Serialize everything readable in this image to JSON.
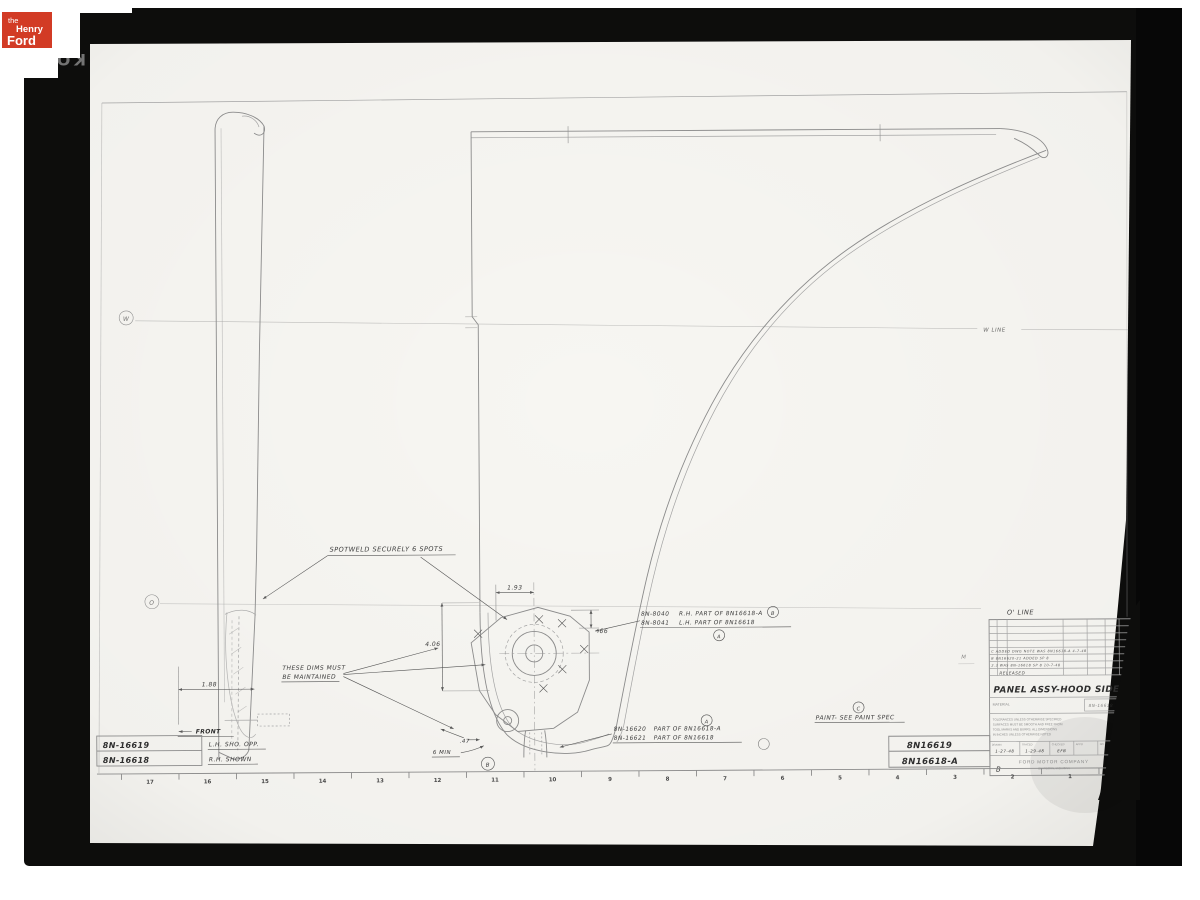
{
  "colors": {
    "logo_red": "#d23b25",
    "film_black": "#0d0d0c",
    "paper": "#f7f6f2",
    "ink": "#3b3b3b"
  },
  "branding": {
    "logo": {
      "line1": "the",
      "line2": "Henry",
      "line3": "Ford"
    },
    "film_marking": "KOD"
  },
  "callouts": {
    "spotweld": "SPOTWELD SECURELY 6 SPOTS",
    "maintain_1": "THESE DIMS MUST",
    "maintain_2": "BE MAINTAINED",
    "hinge_rh_num": "8N-8040",
    "hinge_rh_desc": "R.H. PART OF 8N16618-A",
    "hinge_lh_num": "8N-8041",
    "hinge_lh_desc": "L.H. PART OF 8N16618",
    "brace_rh_num": "8N-16620",
    "brace_rh_desc": "PART OF 8N16618-A",
    "brace_lh_num": "8N-16621",
    "brace_lh_desc": "PART OF 8N16618",
    "paint": "PAINT- SEE PAINT SPEC",
    "front": "FRONT"
  },
  "dimensions": {
    "width_193": "1.93",
    "depth_66": ".66",
    "height_406": "4.06",
    "width_188": "1.88",
    "width_47": ".47",
    "min_6": "6 MIN"
  },
  "datums": {
    "w_line": "W LINE",
    "o_line": "O' LINE",
    "w": "W",
    "o": "O",
    "a": "A",
    "b": "B",
    "c": "C",
    "b_section": "B",
    "m": "M"
  },
  "part_list": {
    "rows": [
      {
        "number": "8N-16619",
        "note": "L.H. SHO. OPP."
      },
      {
        "number": "8N-16618",
        "note": "R.H. SHOWN"
      }
    ]
  },
  "corner_numbers": [
    "8N16619",
    "8N16618-A"
  ],
  "title_block": {
    "revisions": [
      "C  ADDED DWG NOTE  WAS 8N16618-A  4-7-48",
      "B  8N16620-21 ADDED  SP 8",
      "2.3  WAS 8N-16618  SP 8  10-7-48"
    ],
    "released": "RELEASED",
    "title": "PANEL ASSY-HOOD SIDE",
    "material_label": "MATERIAL",
    "material_value": "8N-16618",
    "tolerance_note": [
      "TOLERANCES UNLESS OTHERWISE SPECIFIED",
      "SURFACES MUST BE SMOOTH AND FREE FROM",
      "TOOL MARKS AND BURRS. ALL DIMENSIONS",
      "IN INCHES UNLESS OTHERWISE NOTED"
    ],
    "sign_labels": [
      "DRAWN",
      "TRACED",
      "CHECKED",
      "APPD",
      "NO."
    ],
    "sign_values": [
      "1-27-48",
      "1-29-48",
      "EFB",
      "",
      "1564"
    ],
    "company": "FORD MOTOR COMPANY",
    "location": "DEARBORN, MICHIGAN",
    "corner_letter": "B"
  },
  "ruler": {
    "marks": [
      "17",
      "16",
      "15",
      "14",
      "13",
      "12",
      "11",
      "10",
      "9",
      "8",
      "7",
      "6",
      "5",
      "4",
      "3",
      "2",
      "1"
    ]
  }
}
